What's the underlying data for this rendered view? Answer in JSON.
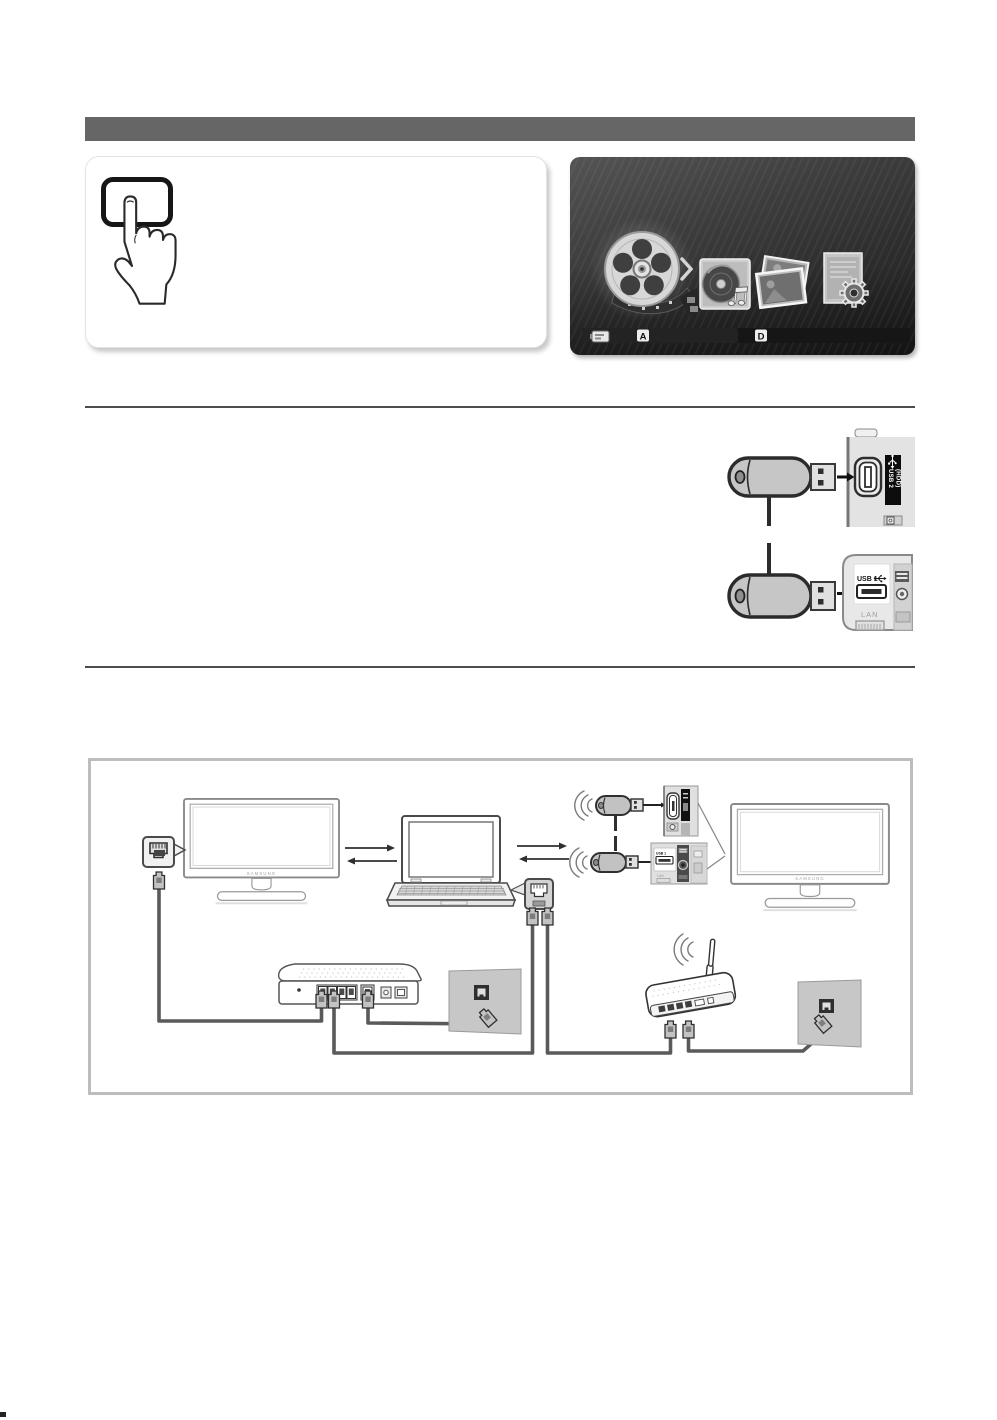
{
  "theme": {
    "header_bar_color": "#666666",
    "divider_color": "#4d4d4d",
    "diagram_border_color": "#bdbdbd",
    "cable_color": "#5a5a5a",
    "screen_dark_color": "#2d2d2d"
  },
  "media_screen": {
    "icons": [
      "videos-film-reel",
      "music-disc",
      "photos",
      "settings-gear"
    ],
    "bottom_bar": {
      "device_icon": "usb-device",
      "badge_a": "A",
      "badge_d": "D"
    }
  },
  "usb_ports": {
    "usb2_line1": "USB 2",
    "usb2_line2": "(HDD)",
    "usb1_label": "USB 1",
    "lan_label": "LAN"
  },
  "network": {
    "left_tv_logo": "SAMSUNG",
    "right_tv_logo": "SAMSUNG",
    "mini_usb1_label": "USB 1",
    "mini_lan_label": "LAN"
  }
}
